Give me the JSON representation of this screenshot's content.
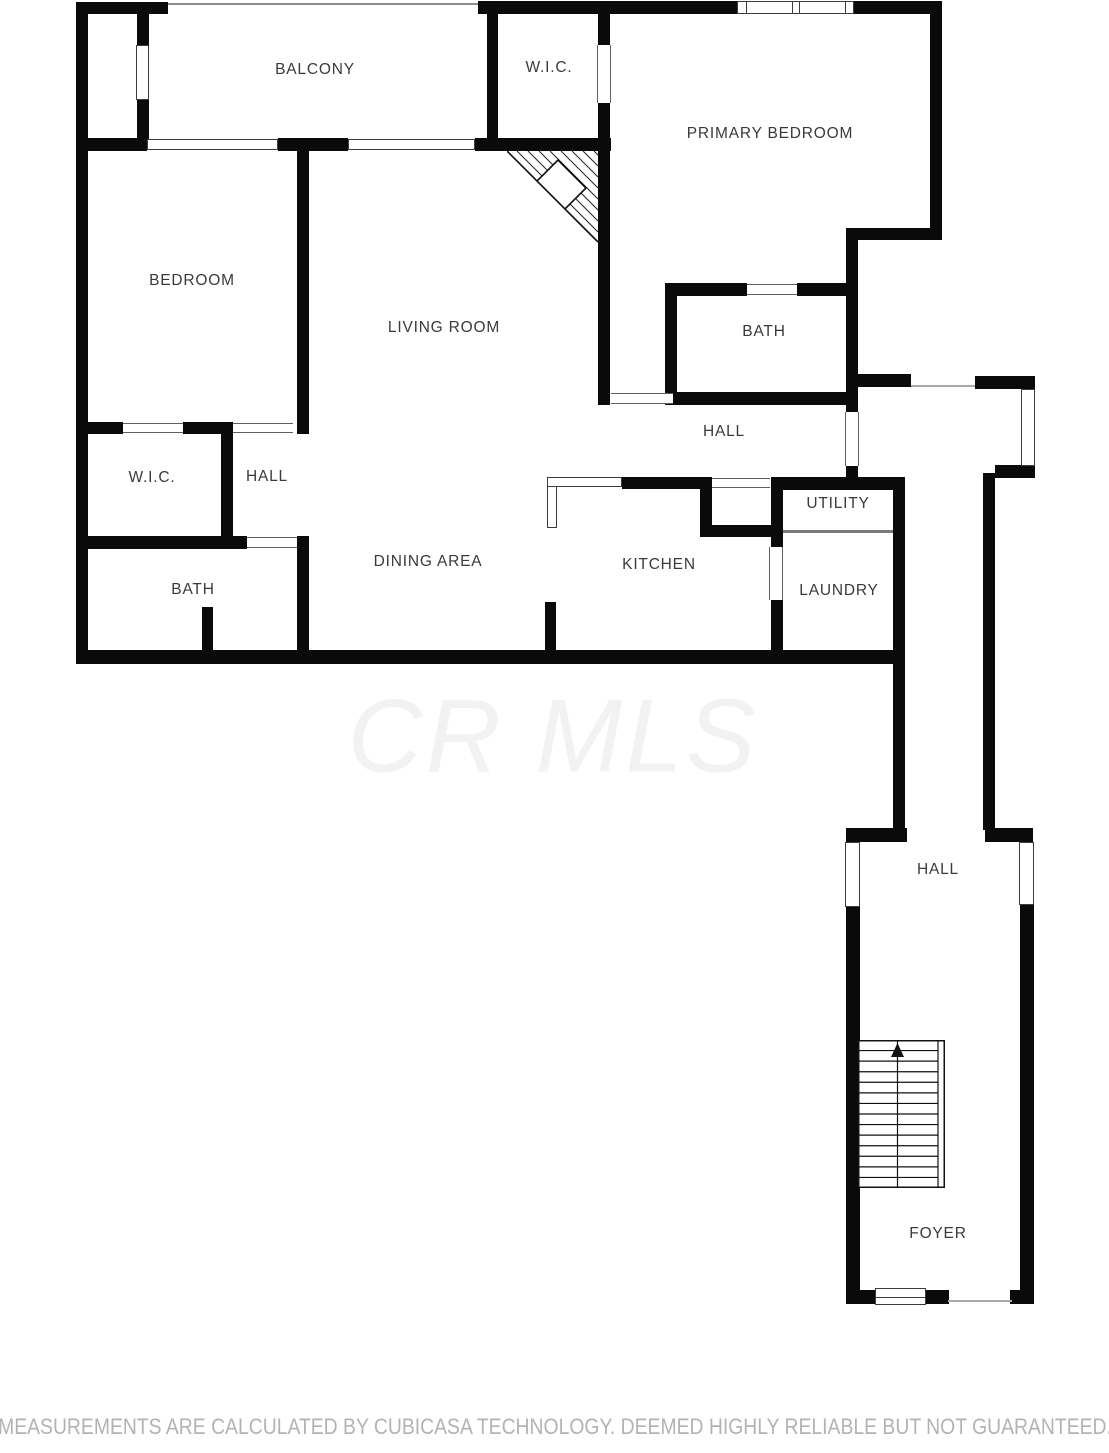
{
  "watermark": {
    "text": "CR MLS",
    "color": "#f2f2f2"
  },
  "footer": {
    "disclaimer": "MEASUREMENTS ARE CALCULATED BY CUBICASA TECHNOLOGY. DEEMED HIGHLY RELIABLE BUT NOT GUARANTEED.",
    "color": "#b3b3b3"
  },
  "plan": {
    "width": 1109,
    "height": 1453,
    "wall_color": "#0a0a0a",
    "label_color": "#3a3a3a",
    "frame_color": "#3c3c3c",
    "rooms": [
      {
        "label": "BALCONY",
        "x": 315,
        "y": 70
      },
      {
        "label": "W.I.C.",
        "x": 549,
        "y": 68
      },
      {
        "label": "PRIMARY BEDROOM",
        "x": 770,
        "y": 134
      },
      {
        "label": "BEDROOM",
        "x": 192,
        "y": 281
      },
      {
        "label": "LIVING ROOM",
        "x": 444,
        "y": 328
      },
      {
        "label": "BATH",
        "x": 764,
        "y": 332
      },
      {
        "label": "HALL",
        "x": 724,
        "y": 432
      },
      {
        "label": "W.I.C.",
        "x": 152,
        "y": 478
      },
      {
        "label": "HALL",
        "x": 267,
        "y": 477
      },
      {
        "label": "UTILITY",
        "x": 838,
        "y": 504
      },
      {
        "label": "DINING AREA",
        "x": 428,
        "y": 562
      },
      {
        "label": "KITCHEN",
        "x": 659,
        "y": 565
      },
      {
        "label": "LAUNDRY",
        "x": 839,
        "y": 591
      },
      {
        "label": "BATH",
        "x": 193,
        "y": 590
      },
      {
        "label": "HALL",
        "x": 938,
        "y": 870
      },
      {
        "label": "FOYER",
        "x": 938,
        "y": 1234
      }
    ],
    "walls": [
      [
        76,
        2,
        12,
        662
      ],
      [
        76,
        2,
        92,
        12
      ],
      [
        478,
        1,
        464,
        13
      ],
      [
        137,
        2,
        12,
        43
      ],
      [
        137,
        100,
        12,
        40
      ],
      [
        76,
        138,
        71,
        13
      ],
      [
        278,
        138,
        70,
        13
      ],
      [
        475,
        138,
        136,
        13
      ],
      [
        487,
        12,
        11,
        128
      ],
      [
        598,
        12,
        12,
        33
      ],
      [
        598,
        103,
        12,
        45
      ],
      [
        598,
        148,
        12,
        257
      ],
      [
        930,
        2,
        12,
        238
      ],
      [
        846,
        228,
        96,
        12
      ],
      [
        846,
        228,
        12,
        184
      ],
      [
        665,
        283,
        82,
        13
      ],
      [
        797,
        283,
        49,
        13
      ],
      [
        665,
        283,
        12,
        122
      ],
      [
        673,
        392,
        173,
        13
      ],
      [
        846,
        374,
        65,
        13
      ],
      [
        975,
        376,
        60,
        13
      ],
      [
        995,
        465,
        40,
        13
      ],
      [
        983,
        473,
        12,
        357
      ],
      [
        893,
        477,
        12,
        353
      ],
      [
        846,
        466,
        12,
        12
      ],
      [
        772,
        477,
        131,
        13
      ],
      [
        771,
        477,
        12,
        70
      ],
      [
        771,
        600,
        12,
        50
      ],
      [
        622,
        477,
        90,
        12
      ],
      [
        700,
        487,
        12,
        40
      ],
      [
        700,
        525,
        72,
        12
      ],
      [
        297,
        138,
        12,
        296
      ],
      [
        76,
        422,
        47,
        12
      ],
      [
        183,
        422,
        50,
        12
      ],
      [
        221,
        422,
        12,
        127
      ],
      [
        76,
        536,
        171,
        13
      ],
      [
        297,
        536,
        12,
        128
      ],
      [
        202,
        607,
        11,
        45
      ],
      [
        545,
        602,
        11,
        50
      ],
      [
        76,
        650,
        829,
        14
      ],
      [
        846,
        828,
        61,
        14
      ],
      [
        985,
        828,
        48,
        14
      ],
      [
        846,
        906,
        14,
        398
      ],
      [
        1020,
        904,
        14,
        386
      ],
      [
        846,
        1290,
        32,
        14
      ],
      [
        924,
        1290,
        25,
        14
      ],
      [
        1010,
        1290,
        24,
        14
      ]
    ],
    "thin_lines": [
      [
        168,
        3,
        310,
        2,
        "#8c8c8c"
      ],
      [
        911,
        385,
        64,
        2,
        "#aaaaaa"
      ],
      [
        948,
        1300,
        64,
        2,
        "#aaaaaa"
      ],
      [
        783,
        530,
        110,
        3,
        "#7a7a7a"
      ]
    ],
    "counters": [
      [
        547,
        477,
        75,
        10
      ],
      [
        547,
        486,
        10,
        42
      ]
    ],
    "doors": [
      {
        "x": 597,
        "y": 45,
        "w": 14,
        "h": 58,
        "o": "v"
      },
      {
        "x": 747,
        "y": 284,
        "w": 50,
        "h": 11,
        "o": "h"
      },
      {
        "x": 611,
        "y": 393,
        "w": 62,
        "h": 11,
        "o": "h"
      },
      {
        "x": 845,
        "y": 412,
        "w": 14,
        "h": 54,
        "o": "v"
      },
      {
        "x": 712,
        "y": 478,
        "w": 58,
        "h": 10,
        "o": "h"
      },
      {
        "x": 769,
        "y": 547,
        "w": 14,
        "h": 53,
        "o": "v"
      },
      {
        "x": 123,
        "y": 423,
        "w": 60,
        "h": 10,
        "o": "h"
      },
      {
        "x": 233,
        "y": 423,
        "w": 60,
        "h": 10,
        "o": "h"
      },
      {
        "x": 247,
        "y": 537,
        "w": 50,
        "h": 11,
        "o": "h"
      }
    ],
    "windows": [
      {
        "x": 737,
        "y": 1,
        "w": 117,
        "h": 13,
        "vl": [
          0.07,
          0.47,
          0.53,
          0.93
        ],
        "hl": []
      },
      {
        "x": 147,
        "y": 139,
        "w": 131,
        "h": 11,
        "vl": [],
        "hl": []
      },
      {
        "x": 348,
        "y": 139,
        "w": 127,
        "h": 11,
        "vl": [],
        "hl": []
      },
      {
        "x": 136,
        "y": 45,
        "w": 13,
        "h": 55,
        "vl": [],
        "hl": []
      },
      {
        "x": 1021,
        "y": 389,
        "w": 14,
        "h": 77,
        "vl": [],
        "hl": []
      },
      {
        "x": 845,
        "y": 842,
        "w": 15,
        "h": 65,
        "vl": [],
        "hl": []
      },
      {
        "x": 1019,
        "y": 842,
        "w": 15,
        "h": 63,
        "vl": [],
        "hl": []
      },
      {
        "x": 875,
        "y": 1288,
        "w": 51,
        "h": 17,
        "vl": [],
        "hl": [
          0.5
        ]
      }
    ],
    "stairs": {
      "x": 858,
      "y": 1040,
      "w": 87,
      "h": 148,
      "steps": 14,
      "divider_x": 39.5,
      "stringer_x": 80
    },
    "hatch": {
      "x": 507,
      "y": 151,
      "size": 92,
      "triangle": "0,0 91,0 91,91",
      "line_offsets": [
        10,
        21,
        32,
        43,
        54,
        65,
        76,
        87
      ],
      "diamond": "51,9 79,37 51,65 23,37"
    }
  }
}
